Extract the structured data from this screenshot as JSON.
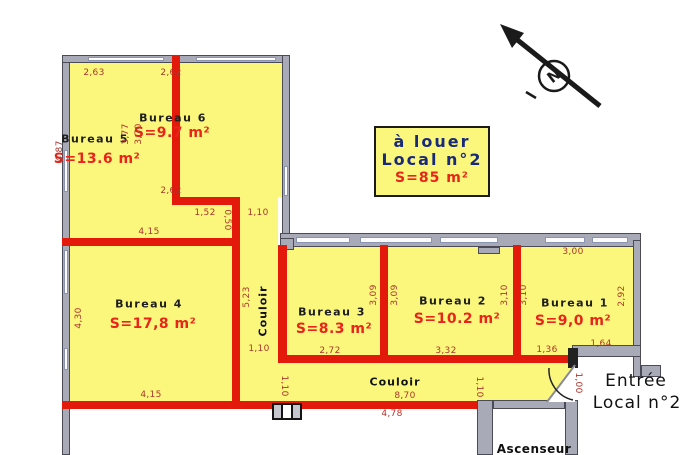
{
  "colors": {
    "room_fill": "#fbf77d",
    "wall_red": "#e2190b",
    "wall_gray": "#a9aab8",
    "dim_text": "#ad352c",
    "area_text": "#e8251a",
    "title_text": "#1a2a7a"
  },
  "title_box": {
    "line1": "à louer",
    "line2": "Local n°2",
    "line3": "S=85 m²"
  },
  "rooms": {
    "b5": {
      "name": "Bureau 5",
      "area": "S=13.6 m²"
    },
    "b6": {
      "name": "Bureau 6",
      "area": "S=9.7 m²"
    },
    "b4": {
      "name": "Bureau 4",
      "area": "S=17,8 m²"
    },
    "b3": {
      "name": "Bureau 3",
      "area": "S=8.3 m²"
    },
    "b2": {
      "name": "Bureau 2",
      "area": "S=10.2 m²"
    },
    "b1": {
      "name": "Bureau 1",
      "area": "S=9,0 m²"
    }
  },
  "corridors": {
    "vertical": "Couloir",
    "horizontal": "Couloir"
  },
  "labels": {
    "entree_line1": "Entrée",
    "entree_line2": "Local n°2",
    "ascenseur": "Ascenseur",
    "north": "N"
  },
  "dims": {
    "b5_top": "2,63",
    "b6_top": "2,62",
    "b5_left": "4,87",
    "div56_l": "3,77",
    "div56_r": "3,70",
    "b6_bottom": "2,62",
    "pass_152": "1,52",
    "pass_050": "0,50",
    "pass_110": "1,10",
    "b4_top": "4,15",
    "b4_left": "4,30",
    "b4_bottom": "4,15",
    "cv_len": "5,23",
    "cv_w": "1,10",
    "b3_r1": "3,09",
    "b3_r2": "3,09",
    "b3_bottom": "2,72",
    "b2_bottom": "3,32",
    "b2_r1": "3,10",
    "b2_r2": "3,10",
    "b1_top": "3,00",
    "b1_right": "2,92",
    "b1_bottom_l": "1,36",
    "b1_bottom_r": "1,64",
    "ch_w1": "1,10",
    "ch_len": "8,70",
    "ch_w2": "1,10",
    "door": "1,00",
    "ch_under": "4,78"
  }
}
